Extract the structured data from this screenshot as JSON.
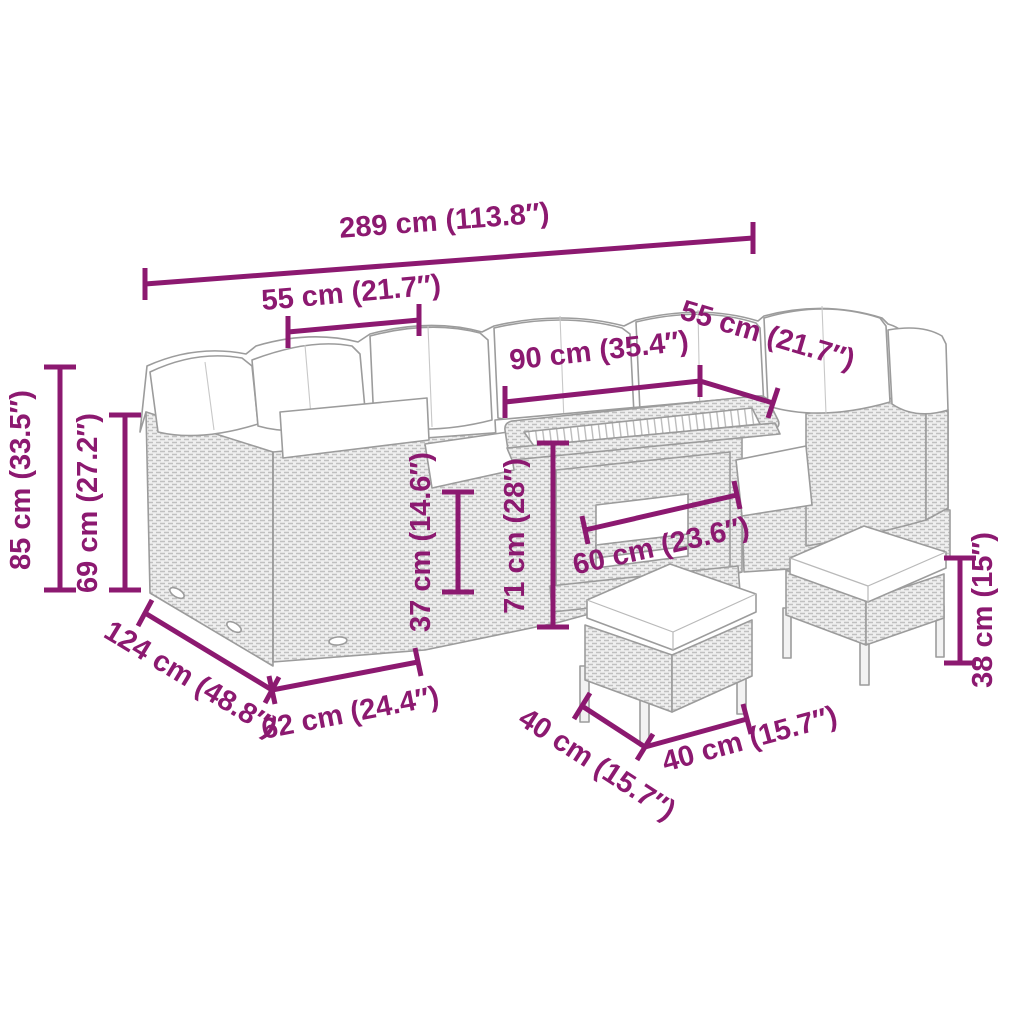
{
  "page": {
    "background": "#FFFFFF"
  },
  "colors": {
    "dimension_accent": "#8C1970",
    "furniture_outline": "#9C9C9C",
    "rattan_texture": "#C4C4C4",
    "cushion_fill": "#FFFFFF"
  },
  "dimensions": {
    "total_width": "289 cm (113.8″)",
    "left_seat_width": "55 cm (21.7″)",
    "right_seat_width": "55 cm (21.7″)",
    "table_length": "90 cm (35.4″)",
    "back_height": "85 cm (33.5″)",
    "backrest_height": "69 cm (27.2″)",
    "seat_height": "37 cm (14.6″)",
    "table_height": "71 cm (28″)",
    "table_width": "60 cm (23.6″)",
    "sofa_depth": "124 cm (48.8″)",
    "corner_section_width": "62 cm (24.4″)",
    "stool_depth": "40 cm (15.7″)",
    "stool_width": "40 cm (15.7″)",
    "stool_height": "38 cm (15″)"
  }
}
